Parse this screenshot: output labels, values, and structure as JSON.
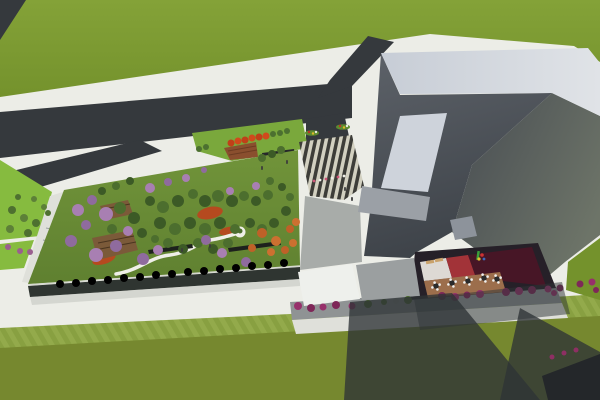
{
  "meta": {
    "title": "Aerial 3D architectural rendering",
    "description": "Bird's-eye render: forked asphalt road over grass at top-left, a low annex building with a dense rooftop garden (flowering purple, green and orange trees, winding white path, wood decks), a zebra-striped entry plaza, a large angular gray building with light roof band and skylight, an open terrace courtyard with round tables, loungers and a small playground, rows of magenta shrubs along a street, mowed lawn bands and long building shadows at the bottom.",
    "canvas": {
      "width": 600,
      "height": 400
    }
  },
  "palette": {
    "paving": "#ecede7",
    "paving_shade": "#dfe0da",
    "road": "#35393d",
    "grass_a": "#84a238",
    "grass_b": "#74922c",
    "grass_bottom": "#76882f",
    "lawn_stripe_a": "#93aa4b",
    "lawn_stripe_b": "#88a041",
    "garden_a": "#71943a",
    "garden_b": "#5f8030",
    "park_lawn": "#7aa83c",
    "vivid_green": "#86bb3f",
    "roof_a": "#c7cdd6",
    "roof_b": "#e0e3e7",
    "slope_a": "#5d6269",
    "slope_b": "#3e4349",
    "wing_a": "#474c52",
    "wing_b": "#6d7468",
    "skylight": "#ced3db",
    "door_panel": "#8d939b",
    "plaza_roof": "#9ba0a6",
    "walk_shaded": "#a8aca9",
    "plaza_dark": "#3d3d38",
    "plaza_light": "#d2d0c0",
    "facade_glass": "#2f3531",
    "parapet": "#d6d8d0",
    "tiers_brown": "#8a4f2e",
    "tiers_line": "#6d3c22",
    "sign_dark": "#26282a",
    "wood_deck": "#7b5a39",
    "pergola": "#4a3520",
    "bench_dark": "#1d211d",
    "path_white": "#efefe8",
    "courtyard_dark": "#262028",
    "floor_white": "#ddd9d4",
    "floor_red": "#a23338",
    "floor_maroon": "#471626",
    "deck_brown": "#9c6e4c",
    "canopy_white": "#eef0ec",
    "canopy_gray": "#9b9fa0",
    "street_gray": "#8f9394",
    "shadow": "#2e3336",
    "asphalt": "#24272a",
    "lounger_tan": "#c9a26b",
    "table_dark": "#2b2b2b",
    "chair_white": "#f0f0ee",
    "person_dark": "#3c3c3c",
    "stair_mark": "#9aa0a0"
  },
  "scene": {
    "regions": [
      {
        "id": "grass-field",
        "label": "grass field"
      },
      {
        "id": "road-fork",
        "label": "forked asphalt road"
      },
      {
        "id": "rooftop-garden",
        "label": "rooftop garden on annex building"
      },
      {
        "id": "entry-plaza",
        "label": "striped entry plaza"
      },
      {
        "id": "main-building",
        "label": "angular gray building"
      },
      {
        "id": "terrace-courtyard",
        "label": "terrace courtyard with tables and playground"
      },
      {
        "id": "shrub-street",
        "label": "street with flowering shrubs"
      },
      {
        "id": "lawn-bands",
        "label": "mowed lawn bands"
      },
      {
        "id": "building-shadows",
        "label": "cast building shadows"
      }
    ],
    "vegetation": [
      {
        "layer": "garden-purple",
        "name": "flowering-tree-purple",
        "shape": "circle",
        "color": "#a87fb2",
        "alt": "#8f6b9e",
        "items": [
          [
            78,
            210,
            6
          ],
          [
            92,
            200,
            5
          ],
          [
            106,
            214,
            7
          ],
          [
            71,
            241,
            6
          ],
          [
            96,
            255,
            7
          ],
          [
            116,
            246,
            6
          ],
          [
            128,
            231,
            5
          ],
          [
            143,
            259,
            6
          ],
          [
            158,
            250,
            5
          ],
          [
            86,
            225,
            5
          ],
          [
            150,
            188,
            5
          ],
          [
            168,
            182,
            4
          ],
          [
            186,
            178,
            4
          ],
          [
            206,
            240,
            5
          ],
          [
            222,
            253,
            5
          ],
          [
            246,
            262,
            5
          ],
          [
            230,
            191,
            4
          ],
          [
            204,
            170,
            3
          ],
          [
            256,
            186,
            4
          ]
        ]
      },
      {
        "layer": "garden-green",
        "name": "tree-green",
        "shape": "circle",
        "color": "#4c6e2e",
        "alt": "#3c5a26",
        "items": [
          [
            120,
            208,
            6
          ],
          [
            134,
            218,
            6
          ],
          [
            112,
            229,
            5
          ],
          [
            150,
            201,
            5
          ],
          [
            163,
            207,
            6
          ],
          [
            178,
            201,
            6
          ],
          [
            193,
            194,
            5
          ],
          [
            205,
            201,
            6
          ],
          [
            218,
            196,
            6
          ],
          [
            232,
            201,
            6
          ],
          [
            244,
            196,
            5
          ],
          [
            256,
            201,
            5
          ],
          [
            268,
            195,
            5
          ],
          [
            160,
            223,
            6
          ],
          [
            175,
            229,
            6
          ],
          [
            190,
            223,
            6
          ],
          [
            205,
            229,
            6
          ],
          [
            220,
            223,
            6
          ],
          [
            235,
            229,
            5
          ],
          [
            250,
            223,
            5
          ],
          [
            262,
            229,
            5
          ],
          [
            274,
            223,
            5
          ],
          [
            168,
            243,
            5
          ],
          [
            183,
            249,
            5
          ],
          [
            198,
            243,
            5
          ],
          [
            213,
            249,
            5
          ],
          [
            228,
            243,
            5
          ],
          [
            142,
            233,
            5
          ],
          [
            155,
            239,
            4
          ],
          [
            286,
            211,
            5
          ],
          [
            290,
            197,
            4
          ],
          [
            282,
            187,
            4
          ],
          [
            270,
            181,
            4
          ],
          [
            102,
            191,
            4
          ],
          [
            116,
            186,
            4
          ],
          [
            130,
            181,
            4
          ],
          [
            262,
            158,
            4
          ],
          [
            272,
            154,
            4
          ],
          [
            281,
            150,
            4
          ]
        ]
      },
      {
        "layer": "garden-orange",
        "name": "tree-autumn-orange",
        "shape": "circle",
        "color": "#bf6128",
        "alt": "#cc7030",
        "items": [
          [
            262,
            233,
            5
          ],
          [
            276,
            241,
            5
          ],
          [
            290,
            229,
            4
          ],
          [
            271,
            252,
            4
          ],
          [
            285,
            250,
            4
          ],
          [
            293,
            243,
            4
          ],
          [
            252,
            248,
            4
          ],
          [
            296,
            222,
            4
          ]
        ]
      },
      {
        "layer": "garden-hedge",
        "name": "facade-tree-dark",
        "shape": "circle",
        "color": "#243619,",
        "items": [
          [
            60,
            284,
            4
          ],
          [
            76,
            283,
            4
          ],
          [
            92,
            281,
            4
          ],
          [
            108,
            280,
            4
          ],
          [
            124,
            278,
            4
          ],
          [
            140,
            277,
            4
          ],
          [
            156,
            275,
            4
          ],
          [
            172,
            274,
            4
          ],
          [
            188,
            272,
            4
          ],
          [
            204,
            271,
            4
          ],
          [
            220,
            269,
            4
          ],
          [
            236,
            268,
            4
          ],
          [
            252,
            266,
            4
          ],
          [
            268,
            265,
            4
          ],
          [
            284,
            263,
            4
          ]
        ]
      },
      {
        "layer": "garden-groundcover",
        "name": "red-groundcover",
        "shape": "ellipse",
        "color": "#b54a1f",
        "items": [
          [
            104,
            259,
            12,
            5,
            -18
          ],
          [
            210,
            213,
            13,
            6,
            -12
          ],
          [
            228,
            231,
            9,
            4,
            -12
          ]
        ]
      },
      {
        "layer": "minipark-red",
        "name": "small-red-tree",
        "shape": "circle",
        "color": "#c04018",
        "alt": "#d04a1c",
        "items": [
          [
            231,
            143,
            3.5
          ],
          [
            238,
            141,
            3.5
          ],
          [
            245,
            140,
            3.5
          ],
          [
            252,
            138,
            3.5
          ],
          [
            259,
            137,
            3.5
          ],
          [
            266,
            136,
            3.5
          ]
        ]
      },
      {
        "layer": "minipark-green",
        "name": "small-green-tree",
        "shape": "circle",
        "color": "#4c7030",
        "items": [
          [
            273,
            134,
            3
          ],
          [
            280,
            133,
            3
          ],
          [
            287,
            131,
            3
          ],
          [
            199,
            149,
            3
          ],
          [
            206,
            147,
            3
          ]
        ]
      },
      {
        "layer": "left-strip-green",
        "name": "shrub-green",
        "shape": "circle",
        "color": "#4e7030",
        "alt": "#5d8038",
        "items": [
          [
            12,
            210,
            4
          ],
          [
            24,
            218,
            4
          ],
          [
            36,
            223,
            4
          ],
          [
            10,
            229,
            4
          ],
          [
            28,
            233,
            4
          ],
          [
            44,
            207,
            3
          ],
          [
            18,
            197,
            3
          ],
          [
            34,
            199,
            3
          ],
          [
            48,
            213,
            3
          ]
        ]
      },
      {
        "layer": "left-strip-purple",
        "name": "shrub-purple",
        "shape": "circle",
        "color": "#9a5f8f",
        "items": [
          [
            8,
            247,
            3
          ],
          [
            20,
            251,
            3
          ],
          [
            30,
            252,
            3
          ]
        ]
      },
      {
        "layer": "street-magenta",
        "name": "shrub-magenta",
        "shape": "circle",
        "color": "#97306b",
        "alt": "#7e2758",
        "items": [
          [
            298,
            306,
            4
          ],
          [
            311,
            308,
            4
          ],
          [
            323,
            307,
            3.5
          ],
          [
            336,
            305,
            4
          ],
          [
            352,
            306,
            3.5
          ],
          [
            442,
            296,
            4
          ],
          [
            455,
            297,
            4
          ],
          [
            467,
            295,
            3.5
          ],
          [
            480,
            294,
            4
          ],
          [
            506,
            292,
            4
          ],
          [
            519,
            291,
            4
          ],
          [
            532,
            290,
            4
          ],
          [
            548,
            289,
            3.5
          ],
          [
            560,
            288,
            3.5
          ],
          [
            554,
            293,
            3
          ],
          [
            580,
            284,
            3.5
          ],
          [
            592,
            282,
            3.5
          ],
          [
            596,
            290,
            3
          ]
        ]
      },
      {
        "layer": "street-green",
        "name": "shrub-street-green",
        "shape": "circle",
        "color": "#4a6b2a",
        "items": [
          [
            368,
            304,
            4
          ],
          [
            384,
            302,
            3
          ],
          [
            408,
            300,
            4
          ]
        ]
      },
      {
        "layer": "street-gray-bush",
        "name": "shrub-gray",
        "shape": "circle",
        "color": "#8a8d8a",
        "items": [
          [
            396,
            301,
            3
          ]
        ]
      },
      {
        "layer": "asphalt-magenta",
        "name": "shrub-magenta-small",
        "shape": "circle",
        "color": "#8e2f63",
        "items": [
          [
            552,
            357,
            2.5
          ],
          [
            564,
            353,
            2.5
          ],
          [
            576,
            350,
            2.5
          ]
        ]
      },
      {
        "layer": "plaza-flowers",
        "name": "flower-dot",
        "shape": "circle",
        "color": "#cc5577",
        "alt": "#eeeee6",
        "items": [
          [
            314,
            181,
            1.4
          ],
          [
            320,
            180,
            1.4
          ],
          [
            326,
            179,
            1.4
          ],
          [
            332,
            178,
            1.4
          ],
          [
            338,
            177,
            1.4
          ],
          [
            344,
            176,
            1.4
          ]
        ]
      }
    ],
    "furniture": {
      "tables": {
        "name": "round-table-with-chairs",
        "color": "#2b2b2b",
        "chair_color": "#f0f0ee",
        "items": [
          [
            436,
            286
          ],
          [
            452,
            283
          ],
          [
            468,
            281
          ],
          [
            484,
            278
          ],
          [
            497,
            279
          ]
        ]
      },
      "loungers": {
        "name": "lounge-chair",
        "color": "#c9a26b",
        "items": [
          [
            430,
            262,
            -10
          ],
          [
            439,
            260,
            -10
          ]
        ]
      },
      "people": {
        "name": "person",
        "color": "#3c3c3c",
        "items": [
          [
            262,
            168
          ],
          [
            287,
            162
          ],
          [
            310,
            171
          ],
          [
            331,
            167
          ],
          [
            345,
            189
          ],
          [
            352,
            199
          ],
          [
            210,
            246
          ],
          [
            182,
            250
          ]
        ]
      },
      "flowerbeds": {
        "name": "flower-bed",
        "leaf": "#5d8a2f",
        "dots": [
          "#c03028",
          "#ddb829",
          "#e8e8e0"
        ],
        "items": [
          [
            312,
            133
          ],
          [
            343,
            127
          ]
        ]
      }
    }
  }
}
